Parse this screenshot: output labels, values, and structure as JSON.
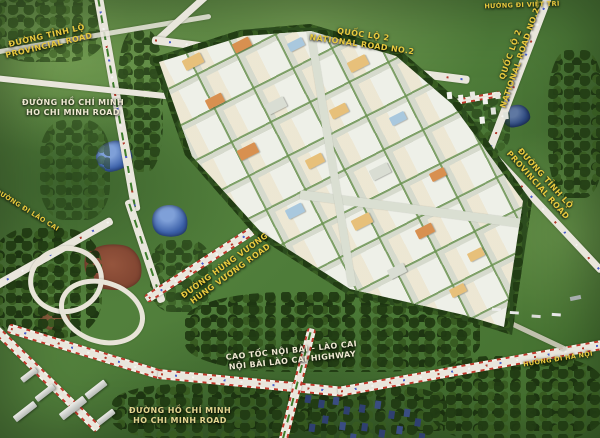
{
  "labels": {
    "provincial_top_left": {
      "line1": "ĐƯỜNG TỈNH LỘ",
      "line2": "PROVINCIAL ROAD"
    },
    "ho_chi_minh_top": {
      "line1": "ĐƯỜNG HỒ CHÍ MINH",
      "line2": "HO CHI MINH ROAD"
    },
    "national_road_2_top": {
      "line1": "QUỐC LỘ 2",
      "line2": "NATIONAL ROAD NO.2"
    },
    "viet_tri": {
      "line1": "HƯỚNG ĐI VIỆT TRÌ"
    },
    "national_road_2_right": {
      "line1": "QUỐC LỘ 2",
      "line2": "NATIONAL ROAD NO.2"
    },
    "provincial_right": {
      "line1": "ĐƯỜNG TỈNH LỘ",
      "line2": "PROVINCIAL ROAD"
    },
    "lao_cai": {
      "line1": "ĐƯỜNG ĐI LÀO CAI"
    },
    "hung_vuong": {
      "line1": "ĐƯỜNG HÙNG VƯƠNG",
      "line2": "HÙNG VƯƠNG ROAD"
    },
    "expressway": {
      "line1": "CAO TỐC NỘI BÀI - LÀO CAI",
      "line2": "NỘI BÀI LÀO CAI HIGHWAY"
    },
    "ha_noi": {
      "line1": "HƯỚNG ĐI HÀ NỘI"
    },
    "ho_chi_minh_bottom": {
      "line1": "ĐƯỜNG HỒ CHÍ MINH",
      "line2": "HO CHI MINH ROAD"
    }
  },
  "colors": {
    "label_gold": "#e8c93e",
    "label_cream": "#efe9d2",
    "road_surface": "#e9e6dc",
    "highway_stripe": "#c0392b",
    "water": "#3a5fa8",
    "water_light": "#7fa0d8",
    "dirt": "#7e4330",
    "park_ground": "#eef0e8",
    "park_street": "#d6dacd"
  }
}
